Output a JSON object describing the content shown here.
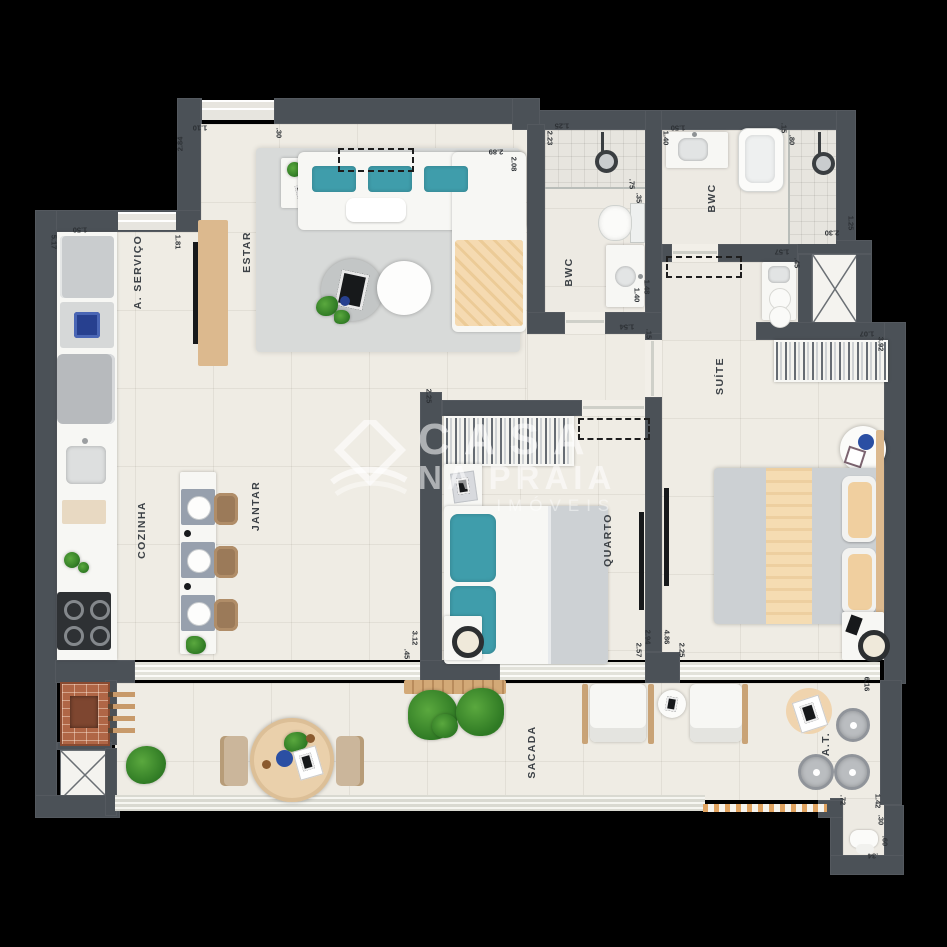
{
  "watermark": {
    "line1": "CASA",
    "line2": "NA PRAIA",
    "line3": "IMÓVEIS"
  },
  "colors": {
    "background": "#000000",
    "wall": "#4b5157",
    "floor": "#efece4",
    "accent_teal": "#3f9dab",
    "accent_peach": "#f3d6aa",
    "wood": "#dcb98e",
    "watermark_text": "rgba(255,255,255,0.55)"
  },
  "rooms": [
    {
      "name": "servico",
      "label": "A. SERVIÇO",
      "x": 138,
      "y": 272
    },
    {
      "name": "estar",
      "label": "ESTAR",
      "x": 247,
      "y": 252
    },
    {
      "name": "cozinha",
      "label": "COZINHA",
      "x": 142,
      "y": 530
    },
    {
      "name": "jantar",
      "label": "JANTAR",
      "x": 256,
      "y": 506
    },
    {
      "name": "bwc-social",
      "label": "BWC",
      "x": 569,
      "y": 272
    },
    {
      "name": "bwc-suite",
      "label": "BWC",
      "x": 712,
      "y": 198
    },
    {
      "name": "quarto",
      "label": "QUARTO",
      "x": 608,
      "y": 540
    },
    {
      "name": "suite",
      "label": "SUÍTE",
      "x": 720,
      "y": 376
    },
    {
      "name": "sacada",
      "label": "SACADA",
      "x": 532,
      "y": 752
    },
    {
      "name": "area-tecnica",
      "label": "A.T.",
      "x": 826,
      "y": 744
    }
  ],
  "dimensions": [
    {
      "t": "2.84",
      "x": 180,
      "y": 144,
      "r": -90
    },
    {
      "t": "1.10",
      "x": 200,
      "y": 128,
      "r": 180
    },
    {
      "t": ".30",
      "x": 279,
      "y": 133,
      "r": 90
    },
    {
      "t": "1.50",
      "x": 80,
      "y": 230,
      "r": 180
    },
    {
      "t": "5.17",
      "x": 54,
      "y": 242,
      "r": 90
    },
    {
      "t": "1.81",
      "x": 178,
      "y": 242,
      "r": 90
    },
    {
      "t": "2.89",
      "x": 496,
      "y": 152,
      "r": 180
    },
    {
      "t": "2.08",
      "x": 514,
      "y": 164,
      "r": 90
    },
    {
      "t": "2.23",
      "x": 550,
      "y": 138,
      "r": 90
    },
    {
      "t": "1.25",
      "x": 562,
      "y": 126,
      "r": 180
    },
    {
      "t": ".75",
      "x": 632,
      "y": 184,
      "r": 90
    },
    {
      "t": ".35",
      "x": 639,
      "y": 198,
      "r": 90
    },
    {
      "t": "1.40",
      "x": 637,
      "y": 295,
      "r": 90
    },
    {
      "t": "1.48",
      "x": 647,
      "y": 287,
      "r": 90
    },
    {
      "t": "1.54",
      "x": 627,
      "y": 327,
      "r": 180
    },
    {
      "t": ".15",
      "x": 649,
      "y": 334,
      "r": 90
    },
    {
      "t": "1.50",
      "x": 678,
      "y": 128,
      "r": 180
    },
    {
      "t": "1.40",
      "x": 666,
      "y": 138,
      "r": 90
    },
    {
      "t": ".15",
      "x": 784,
      "y": 128,
      "r": 90
    },
    {
      "t": ".80",
      "x": 792,
      "y": 140,
      "r": 90
    },
    {
      "t": "2.30",
      "x": 832,
      "y": 233,
      "r": 180
    },
    {
      "t": "1.25",
      "x": 851,
      "y": 223,
      "r": 90
    },
    {
      "t": "1.57",
      "x": 782,
      "y": 252,
      "r": 180
    },
    {
      "t": ".45",
      "x": 797,
      "y": 263,
      "r": 90
    },
    {
      "t": "1.07",
      "x": 867,
      "y": 334,
      "r": 180
    },
    {
      "t": "3.92",
      "x": 881,
      "y": 344,
      "r": 90
    },
    {
      "t": "2.25",
      "x": 429,
      "y": 396,
      "r": 90
    },
    {
      "t": "3.12",
      "x": 415,
      "y": 638,
      "r": 90
    },
    {
      "t": ".45",
      "x": 407,
      "y": 654,
      "r": 90
    },
    {
      "t": "2.57",
      "x": 639,
      "y": 650,
      "r": 90
    },
    {
      "t": "2.94",
      "x": 648,
      "y": 637,
      "r": 90
    },
    {
      "t": "4.86",
      "x": 667,
      "y": 637,
      "r": 90
    },
    {
      "t": "2.25",
      "x": 682,
      "y": 650,
      "r": 90
    },
    {
      "t": "6.16",
      "x": 867,
      "y": 684,
      "r": 90
    },
    {
      "t": ".72",
      "x": 843,
      "y": 800,
      "r": 90
    },
    {
      "t": "1.42",
      "x": 878,
      "y": 801,
      "r": 90
    },
    {
      "t": ".30",
      "x": 881,
      "y": 820,
      "r": 90
    },
    {
      "t": ".60",
      "x": 885,
      "y": 841,
      "r": 90
    },
    {
      "t": ".34",
      "x": 873,
      "y": 856,
      "r": 180
    }
  ]
}
